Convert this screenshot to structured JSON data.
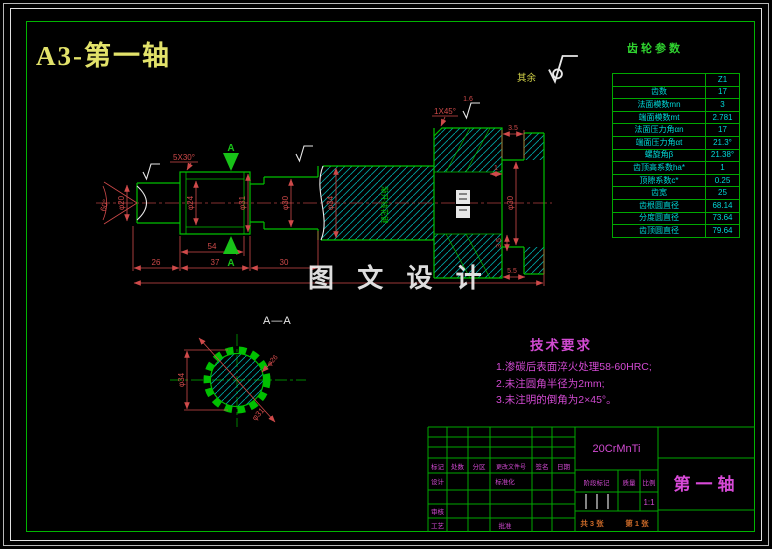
{
  "title": "A3-第一轴",
  "gear_table": {
    "title": "齿轮参数",
    "col_header": "Z1",
    "rows": [
      {
        "label": "齿数",
        "value": "17"
      },
      {
        "label": "法面模数mn",
        "value": "3"
      },
      {
        "label": "端面模数mt",
        "value": "2.781"
      },
      {
        "label": "法面压力角αn",
        "value": "17"
      },
      {
        "label": "端面压力角αt",
        "value": "21.3°"
      },
      {
        "label": "螺旋角β",
        "value": "21.38°"
      },
      {
        "label": "齿顶高系数ha*",
        "value": "1"
      },
      {
        "label": "顶隙系数c*",
        "value": "0.25"
      },
      {
        "label": "齿宽",
        "value": "25"
      },
      {
        "label": "齿根圆直径",
        "value": "68.14"
      },
      {
        "label": "分度圆直径",
        "value": "73.64"
      },
      {
        "label": "齿顶圆直径",
        "value": "79.64"
      }
    ]
  },
  "tech_req": {
    "title": "技术要求",
    "items": [
      "1.渗碳后表面淬火处理58-60HRC;",
      "2.未注圆角半径为2mm;",
      "3.未注明的倒角为2×45°。"
    ]
  },
  "title_block": {
    "material": "20CrMnTi",
    "part_name": "第一轴",
    "col_labels": {
      "c1": "标记",
      "c2": "处数",
      "c3": "分区",
      "c4": "更改文件号",
      "c5": "签名",
      "c6": "日期"
    },
    "row_labels": {
      "design": "设计",
      "standard": "标准化",
      "check": "审核",
      "craft": "工艺",
      "approve": "批准"
    },
    "stage": "阶段标记",
    "mass": "质量",
    "scale": "比例",
    "scale_value": "1:1",
    "sheets_total": "共 3 张",
    "sheet_index": "第 1 张"
  },
  "drawing": {
    "watermark": "图 文 设 计",
    "rest_label": "其余",
    "section_title": "A—A",
    "section_marker": "A",
    "spline_note": "渐开线花键",
    "dims": {
      "cone": "60°",
      "d20": "φ20",
      "ch530": "5X30°",
      "d24": "φ24",
      "d31": "φ31",
      "d30": "φ30",
      "d34": "φ34",
      "len54": "54",
      "len26": "26",
      "len37": "37",
      "len30": "30",
      "ch145": "1X45°",
      "r16": "1.6",
      "w35a": "3.5",
      "w1": "1",
      "d30r": "φ30",
      "w35b": "3.5",
      "w55": "5.5",
      "s34": "φ34",
      "s31": "φ31",
      "s26": "φ26"
    }
  }
}
